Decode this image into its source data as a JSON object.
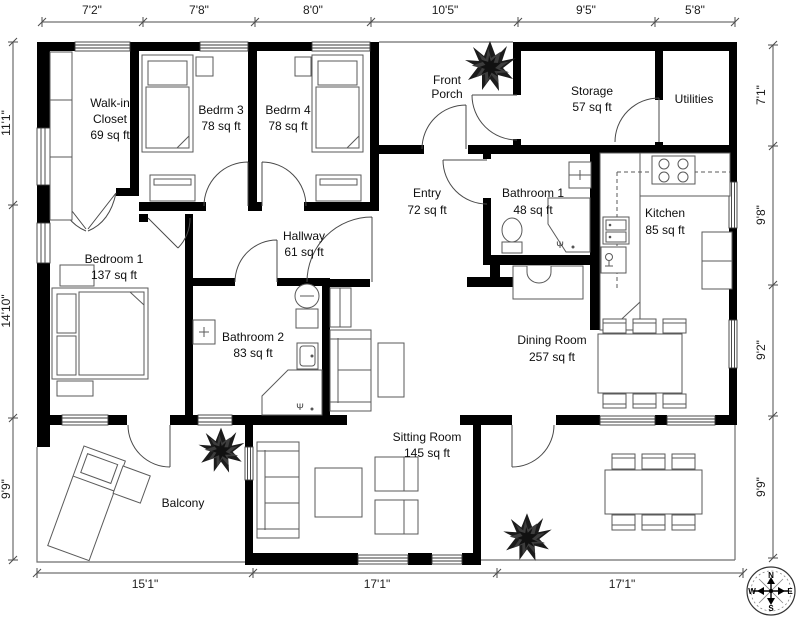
{
  "plan": {
    "rooms": {
      "walk_in_closet": {
        "line1": "Walk-in",
        "line2": "Closet",
        "area": "69 sq ft"
      },
      "bedrm3": {
        "name": "Bedrm 3",
        "area": "78 sq ft"
      },
      "bedrm4": {
        "name": "Bedrm 4",
        "area": "78 sq ft"
      },
      "front_porch": {
        "line1": "Front",
        "line2": "Porch"
      },
      "storage": {
        "name": "Storage",
        "area": "57 sq ft"
      },
      "utilities": {
        "name": "Utilities"
      },
      "entry": {
        "name": "Entry",
        "area": "72 sq ft"
      },
      "bathroom1": {
        "name": "Bathroom 1",
        "area": "48 sq ft"
      },
      "kitchen": {
        "name": "Kitchen",
        "area": "85 sq ft"
      },
      "bedroom1": {
        "name": "Bedroom 1",
        "area": "137 sq ft"
      },
      "hallway": {
        "name": "Hallway",
        "area": "61 sq ft"
      },
      "bathroom2": {
        "name": "Bathroom 2",
        "area": "83 sq ft"
      },
      "dining_room": {
        "name": "Dining Room",
        "area": "257 sq ft"
      },
      "sitting_room": {
        "name": "Sitting Room",
        "area": "145 sq ft"
      },
      "balcony": {
        "name": "Balcony"
      }
    },
    "dimensions": {
      "top": [
        "7'2\"",
        "7'8\"",
        "8'0\"",
        "10'5\"",
        "9'5\"",
        "5'8\""
      ],
      "left": [
        "11'1\"",
        "14'10\"",
        "9'9\""
      ],
      "right": [
        "7'1\"",
        "9'8\"",
        "9'2\"",
        "9'9\""
      ],
      "bottom": [
        "15'1\"",
        "17'1\"",
        "17'1\""
      ]
    },
    "compass": {
      "north": "N",
      "east": "E",
      "south": "S",
      "west": "W"
    },
    "colors": {
      "wall": "#000000",
      "furniture_stroke": "#5a5a5a",
      "text": "#1c1c1c",
      "background": "#ffffff"
    }
  }
}
